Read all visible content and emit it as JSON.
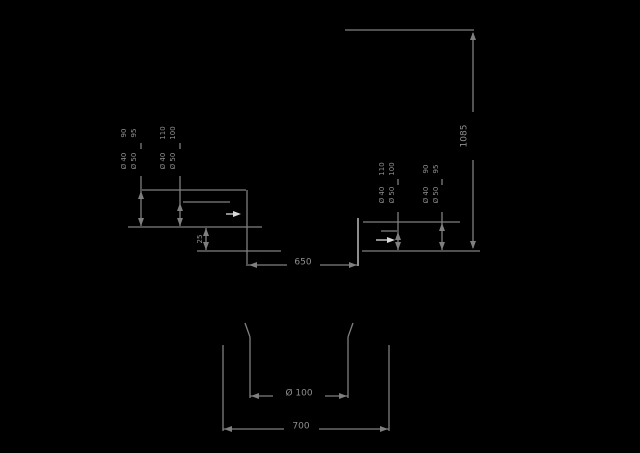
{
  "drawing_title": "installation dimension drawing",
  "canvas": {
    "width": 640,
    "height": 453,
    "background": "#000000"
  },
  "colors": {
    "line": "#7f7f7f",
    "text": "#8f8f8f",
    "bright": "#d9d9d9"
  },
  "dimensions_summary": {
    "overall_height": "1085",
    "recess_width": "650",
    "base_width": "700",
    "hole_diameter": "Ø 100",
    "step_height": "25",
    "connection_heights": [
      "90",
      "95",
      "110",
      "100"
    ],
    "connection_diameters": [
      "Ø 40",
      "Ø 50"
    ]
  },
  "labels": [
    {
      "name": "overall-height-label",
      "text": "1085",
      "x": 464,
      "y": 136,
      "rot": true,
      "size": 9
    },
    {
      "name": "recess-width-label",
      "text": "650",
      "x": 303,
      "y": 262,
      "rot": false,
      "size": 9
    },
    {
      "name": "hole-diameter-label",
      "text": "Ø 100",
      "x": 299,
      "y": 393,
      "rot": false,
      "size": 9
    },
    {
      "name": "base-width-label",
      "text": "700",
      "x": 301,
      "y": 426,
      "rot": false,
      "size": 9
    },
    {
      "name": "step-height-label",
      "text": "25",
      "x": 200,
      "y": 239,
      "rot": true,
      "size": 7
    },
    {
      "name": "left-outer-height-a",
      "text": "90",
      "x": 124,
      "y": 133,
      "rot": true,
      "size": 7
    },
    {
      "name": "left-outer-height-b",
      "text": "95",
      "x": 134,
      "y": 133,
      "rot": true,
      "size": 7
    },
    {
      "name": "left-outer-diameter-a",
      "text": "Ø 40",
      "x": 124,
      "y": 161,
      "rot": true,
      "size": 7
    },
    {
      "name": "left-outer-diameter-b",
      "text": "Ø 50",
      "x": 134,
      "y": 161,
      "rot": true,
      "size": 7
    },
    {
      "name": "left-inner-height-a",
      "text": "110",
      "x": 163,
      "y": 133,
      "rot": true,
      "size": 7
    },
    {
      "name": "left-inner-height-b",
      "text": "100",
      "x": 173,
      "y": 133,
      "rot": true,
      "size": 7
    },
    {
      "name": "left-inner-diameter-a",
      "text": "Ø 40",
      "x": 163,
      "y": 161,
      "rot": true,
      "size": 7
    },
    {
      "name": "left-inner-diameter-b",
      "text": "Ø 50",
      "x": 173,
      "y": 161,
      "rot": true,
      "size": 7
    },
    {
      "name": "right-inner-height-a",
      "text": "110",
      "x": 382,
      "y": 169,
      "rot": true,
      "size": 7
    },
    {
      "name": "right-inner-height-b",
      "text": "100",
      "x": 392,
      "y": 169,
      "rot": true,
      "size": 7
    },
    {
      "name": "right-inner-diameter-a",
      "text": "Ø 40",
      "x": 382,
      "y": 195,
      "rot": true,
      "size": 7
    },
    {
      "name": "right-inner-diameter-b",
      "text": "Ø 50",
      "x": 392,
      "y": 195,
      "rot": true,
      "size": 7
    },
    {
      "name": "right-outer-height-a",
      "text": "90",
      "x": 426,
      "y": 169,
      "rot": true,
      "size": 7
    },
    {
      "name": "right-outer-height-b",
      "text": "95",
      "x": 436,
      "y": 169,
      "rot": true,
      "size": 7
    },
    {
      "name": "right-outer-diameter-a",
      "text": "Ø 40",
      "x": 426,
      "y": 195,
      "rot": true,
      "size": 7
    },
    {
      "name": "right-outer-diameter-b",
      "text": "Ø 50",
      "x": 436,
      "y": 195,
      "rot": true,
      "size": 7
    }
  ],
  "lines": [
    {
      "name": "top-reference-line",
      "x1": 345,
      "y1": 30,
      "x2": 474,
      "y2": 30
    },
    {
      "name": "overall-dim-line-upper",
      "x1": 473,
      "y1": 33,
      "x2": 473,
      "y2": 112
    },
    {
      "name": "overall-dim-line-lower",
      "x1": 473,
      "y1": 160,
      "x2": 473,
      "y2": 248
    },
    {
      "name": "floor-line-right",
      "x1": 362,
      "y1": 251,
      "x2": 480,
      "y2": 251
    },
    {
      "name": "left-upper-ledge",
      "x1": 142,
      "y1": 190,
      "x2": 246,
      "y2": 190
    },
    {
      "name": "left-middle-ledge",
      "x1": 183,
      "y1": 202,
      "x2": 230,
      "y2": 202
    },
    {
      "name": "floor-line-left",
      "x1": 128,
      "y1": 227,
      "x2": 262,
      "y2": 227
    },
    {
      "name": "left-lower-ledge",
      "x1": 197,
      "y1": 251,
      "x2": 281,
      "y2": 251
    },
    {
      "name": "recess-left-wall",
      "x1": 247,
      "y1": 190,
      "x2": 247,
      "y2": 266
    },
    {
      "name": "left-outer-dim-line",
      "x1": 141,
      "y1": 176,
      "x2": 141,
      "y2": 226
    },
    {
      "name": "left-outer-dim-line-gap",
      "x1": 141,
      "y1": 143,
      "x2": 141,
      "y2": 149
    },
    {
      "name": "left-inner-dim-line",
      "x1": 180,
      "y1": 176,
      "x2": 180,
      "y2": 226
    },
    {
      "name": "left-inner-dim-line-gap",
      "x1": 180,
      "y1": 143,
      "x2": 180,
      "y2": 149
    },
    {
      "name": "step-dim-line",
      "x1": 206,
      "y1": 228,
      "x2": 206,
      "y2": 250
    },
    {
      "name": "recess-dim-line-a",
      "x1": 248,
      "y1": 265,
      "x2": 287,
      "y2": 265
    },
    {
      "name": "recess-dim-line-b",
      "x1": 320,
      "y1": 265,
      "x2": 357,
      "y2": 265
    },
    {
      "name": "recess-right-wall",
      "x1": 358,
      "y1": 218,
      "x2": 358,
      "y2": 266,
      "color": "#d9d9d9"
    },
    {
      "name": "right-upper-ledge",
      "x1": 363,
      "y1": 222,
      "x2": 460,
      "y2": 222
    },
    {
      "name": "right-tick-line",
      "x1": 381,
      "y1": 231,
      "x2": 397,
      "y2": 231
    },
    {
      "name": "right-inner-dim-line",
      "x1": 398,
      "y1": 212,
      "x2": 398,
      "y2": 250
    },
    {
      "name": "right-inner-dim-line-gap",
      "x1": 398,
      "y1": 179,
      "x2": 398,
      "y2": 185
    },
    {
      "name": "right-outer-dim-line",
      "x1": 442,
      "y1": 212,
      "x2": 442,
      "y2": 250
    },
    {
      "name": "right-outer-dim-line-gap",
      "x1": 442,
      "y1": 179,
      "x2": 442,
      "y2": 185
    },
    {
      "name": "leader-left-tail",
      "x1": 226,
      "y1": 214,
      "x2": 235,
      "y2": 214,
      "color": "#d9d9d9"
    },
    {
      "name": "leader-right-tail",
      "x1": 376,
      "y1": 240,
      "x2": 388,
      "y2": 240,
      "color": "#d9d9d9"
    },
    {
      "name": "base-outer-left-extension",
      "x1": 223,
      "y1": 345,
      "x2": 223,
      "y2": 431
    },
    {
      "name": "base-outer-right-extension",
      "x1": 389,
      "y1": 345,
      "x2": 389,
      "y2": 431
    },
    {
      "name": "hole-left-extension-tick",
      "x1": 245,
      "y1": 323,
      "x2": 250,
      "y2": 337
    },
    {
      "name": "hole-left-extension",
      "x1": 250,
      "y1": 337,
      "x2": 250,
      "y2": 398
    },
    {
      "name": "hole-right-extension-tick",
      "x1": 353,
      "y1": 323,
      "x2": 348,
      "y2": 337
    },
    {
      "name": "hole-right-extension",
      "x1": 348,
      "y1": 337,
      "x2": 348,
      "y2": 398
    },
    {
      "name": "hole-dim-line-a",
      "x1": 250,
      "y1": 396,
      "x2": 273,
      "y2": 396
    },
    {
      "name": "hole-dim-line-b",
      "x1": 325,
      "y1": 396,
      "x2": 348,
      "y2": 396
    },
    {
      "name": "base-dim-line-a",
      "x1": 223,
      "y1": 429,
      "x2": 284,
      "y2": 429
    },
    {
      "name": "base-dim-line-b",
      "x1": 319,
      "y1": 429,
      "x2": 389,
      "y2": 429
    }
  ],
  "arrows": [
    {
      "name": "overall-dim-arrow-top",
      "x": 473,
      "y": 32,
      "dir": "up"
    },
    {
      "name": "overall-dim-arrow-bottom",
      "x": 473,
      "y": 249,
      "dir": "down"
    },
    {
      "name": "left-outer-arrow-top",
      "x": 141,
      "y": 191,
      "dir": "up"
    },
    {
      "name": "left-outer-arrow-bottom",
      "x": 141,
      "y": 226,
      "dir": "down"
    },
    {
      "name": "left-inner-arrow-top",
      "x": 180,
      "y": 203,
      "dir": "up"
    },
    {
      "name": "left-inner-arrow-bottom",
      "x": 180,
      "y": 226,
      "dir": "down"
    },
    {
      "name": "step-arrow-top",
      "x": 206,
      "y": 228,
      "dir": "up"
    },
    {
      "name": "step-arrow-bottom",
      "x": 206,
      "y": 250,
      "dir": "down"
    },
    {
      "name": "recess-arrow-left",
      "x": 249,
      "y": 265,
      "dir": "left"
    },
    {
      "name": "recess-arrow-right",
      "x": 357,
      "y": 265,
      "dir": "right"
    },
    {
      "name": "right-inner-arrow-top",
      "x": 398,
      "y": 232,
      "dir": "up"
    },
    {
      "name": "right-inner-arrow-bottom",
      "x": 398,
      "y": 250,
      "dir": "down"
    },
    {
      "name": "right-outer-arrow-top",
      "x": 442,
      "y": 223,
      "dir": "up"
    },
    {
      "name": "right-outer-arrow-bottom",
      "x": 442,
      "y": 250,
      "dir": "down"
    },
    {
      "name": "leader-arrow-left",
      "x": 241,
      "y": 214,
      "dir": "right",
      "color": "#d9d9d9"
    },
    {
      "name": "leader-arrow-right",
      "x": 395,
      "y": 240,
      "dir": "right",
      "color": "#d9d9d9"
    },
    {
      "name": "hole-arrow-left",
      "x": 251,
      "y": 396,
      "dir": "left"
    },
    {
      "name": "hole-arrow-right",
      "x": 347,
      "y": 396,
      "dir": "right"
    },
    {
      "name": "base-arrow-left",
      "x": 224,
      "y": 429,
      "dir": "left"
    },
    {
      "name": "base-arrow-right",
      "x": 388,
      "y": 429,
      "dir": "right"
    }
  ]
}
